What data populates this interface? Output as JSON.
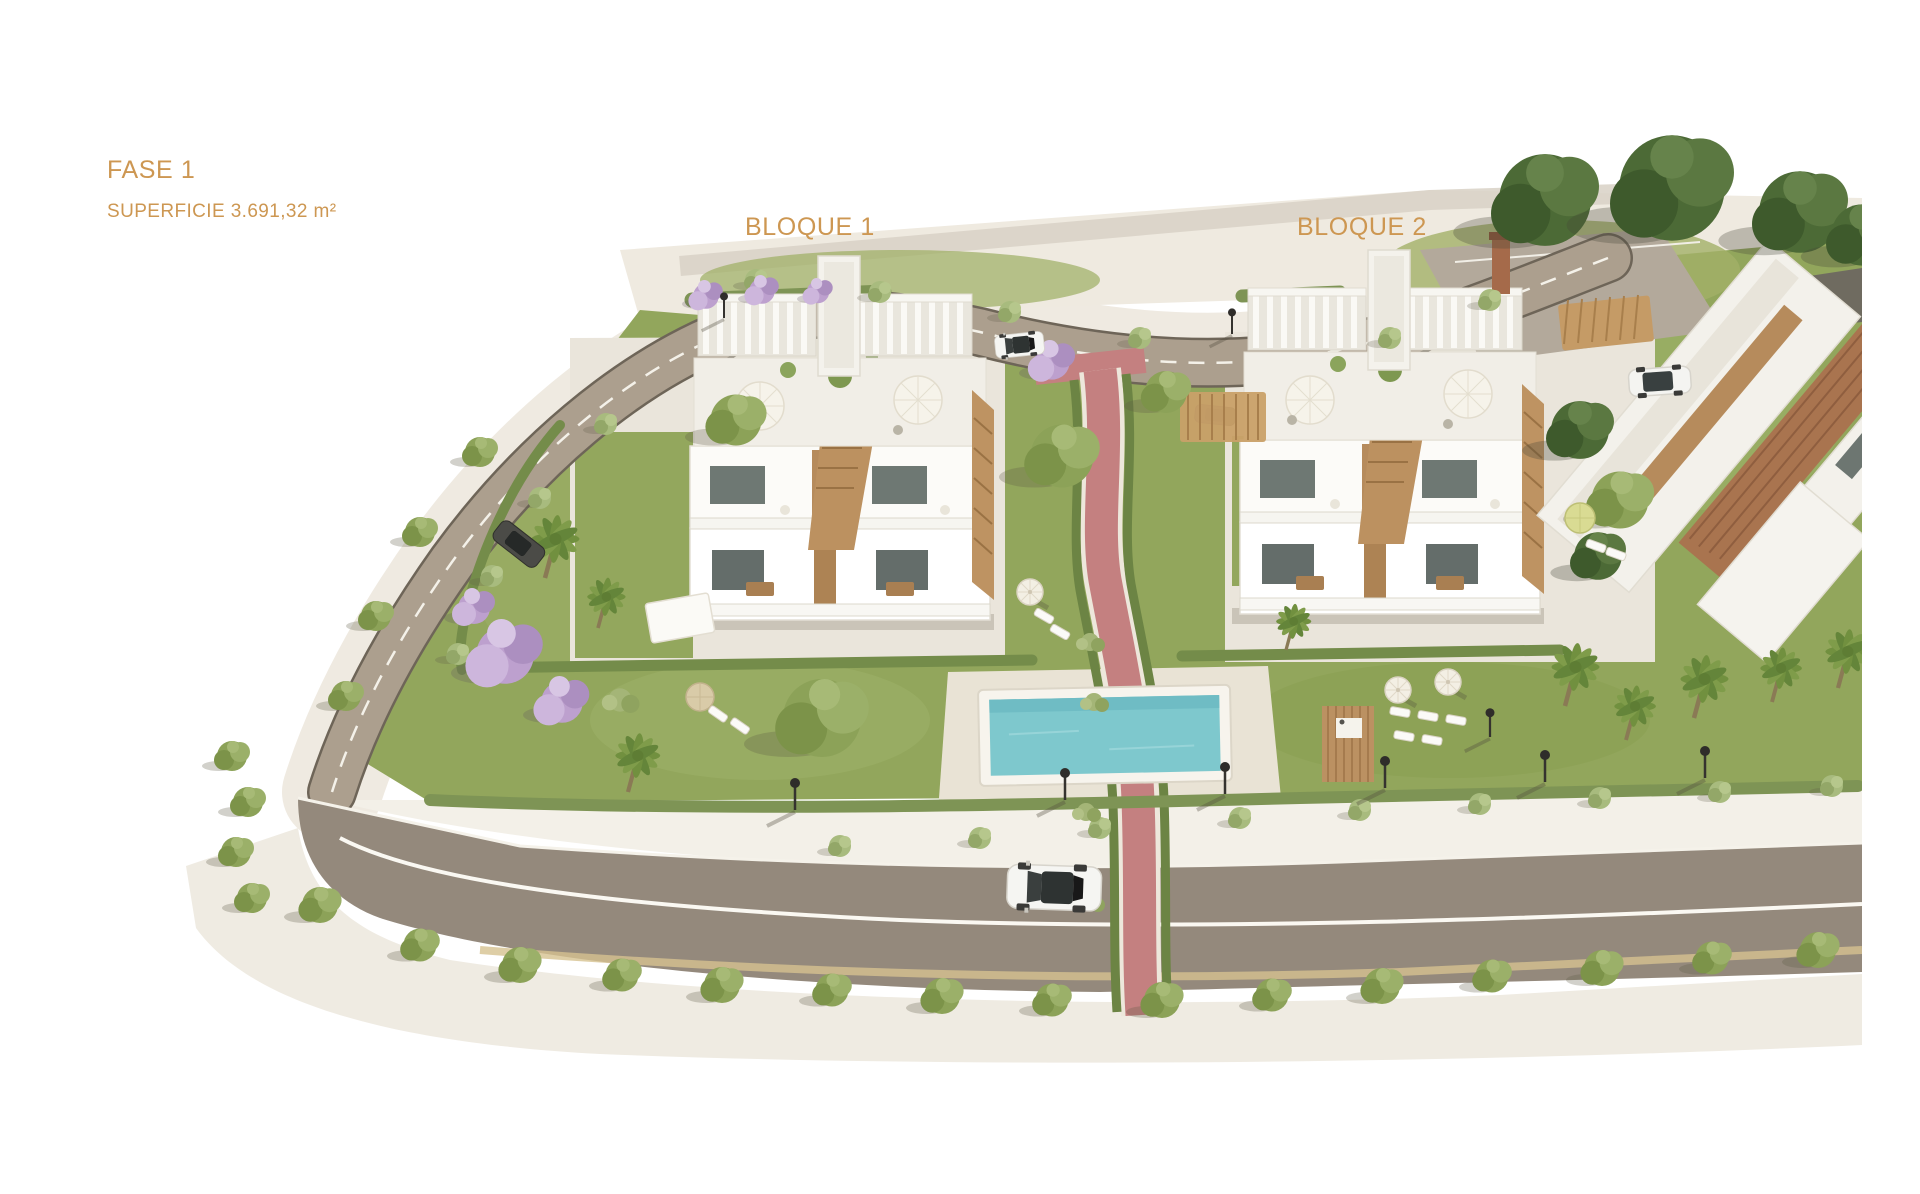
{
  "page": {
    "type": "architectural-site-render",
    "background": "#ffffff"
  },
  "labels": {
    "phase": {
      "text": "FASE 1",
      "color": "#CD9752"
    },
    "area": {
      "text": "SUPERFICIE 3.691,32 m²",
      "color": "#CD9752"
    },
    "block1": {
      "text": "BLOQUE 1",
      "color": "#CD9752"
    },
    "block2": {
      "text": "BLOQUE 2",
      "color": "#CD9752"
    }
  },
  "scene": {
    "elements": [
      "apartment-block-1",
      "apartment-block-2",
      "partial-building-right",
      "swimming-pool",
      "pool-deck",
      "red-walkway",
      "perimeter-road",
      "main-road",
      "inner-road",
      "parking-area",
      "carport",
      "lawns",
      "hedges",
      "palm-trees",
      "jacaranda-trees",
      "street-trees",
      "large-trees",
      "street-lamps",
      "white-car-main-road",
      "white-car-inner-road",
      "dark-car-perimeter-road",
      "white-suv-parking",
      "parasols",
      "sun-loungers",
      "wood-deck",
      "garden-canopy"
    ],
    "colors": {
      "label_text": "#CD9752",
      "pool_water": "#7EC8CD",
      "lawn": "#92A65C",
      "road": "#94897C",
      "perimeter_road": "#AC9F8E",
      "red_path": "#C48080",
      "building": "#F6F4EF",
      "wood_accent": "#BC9160",
      "tree_dark": "#3F5D2F",
      "tree_light": "#93A85D",
      "ground": "#EFEAE1"
    }
  }
}
